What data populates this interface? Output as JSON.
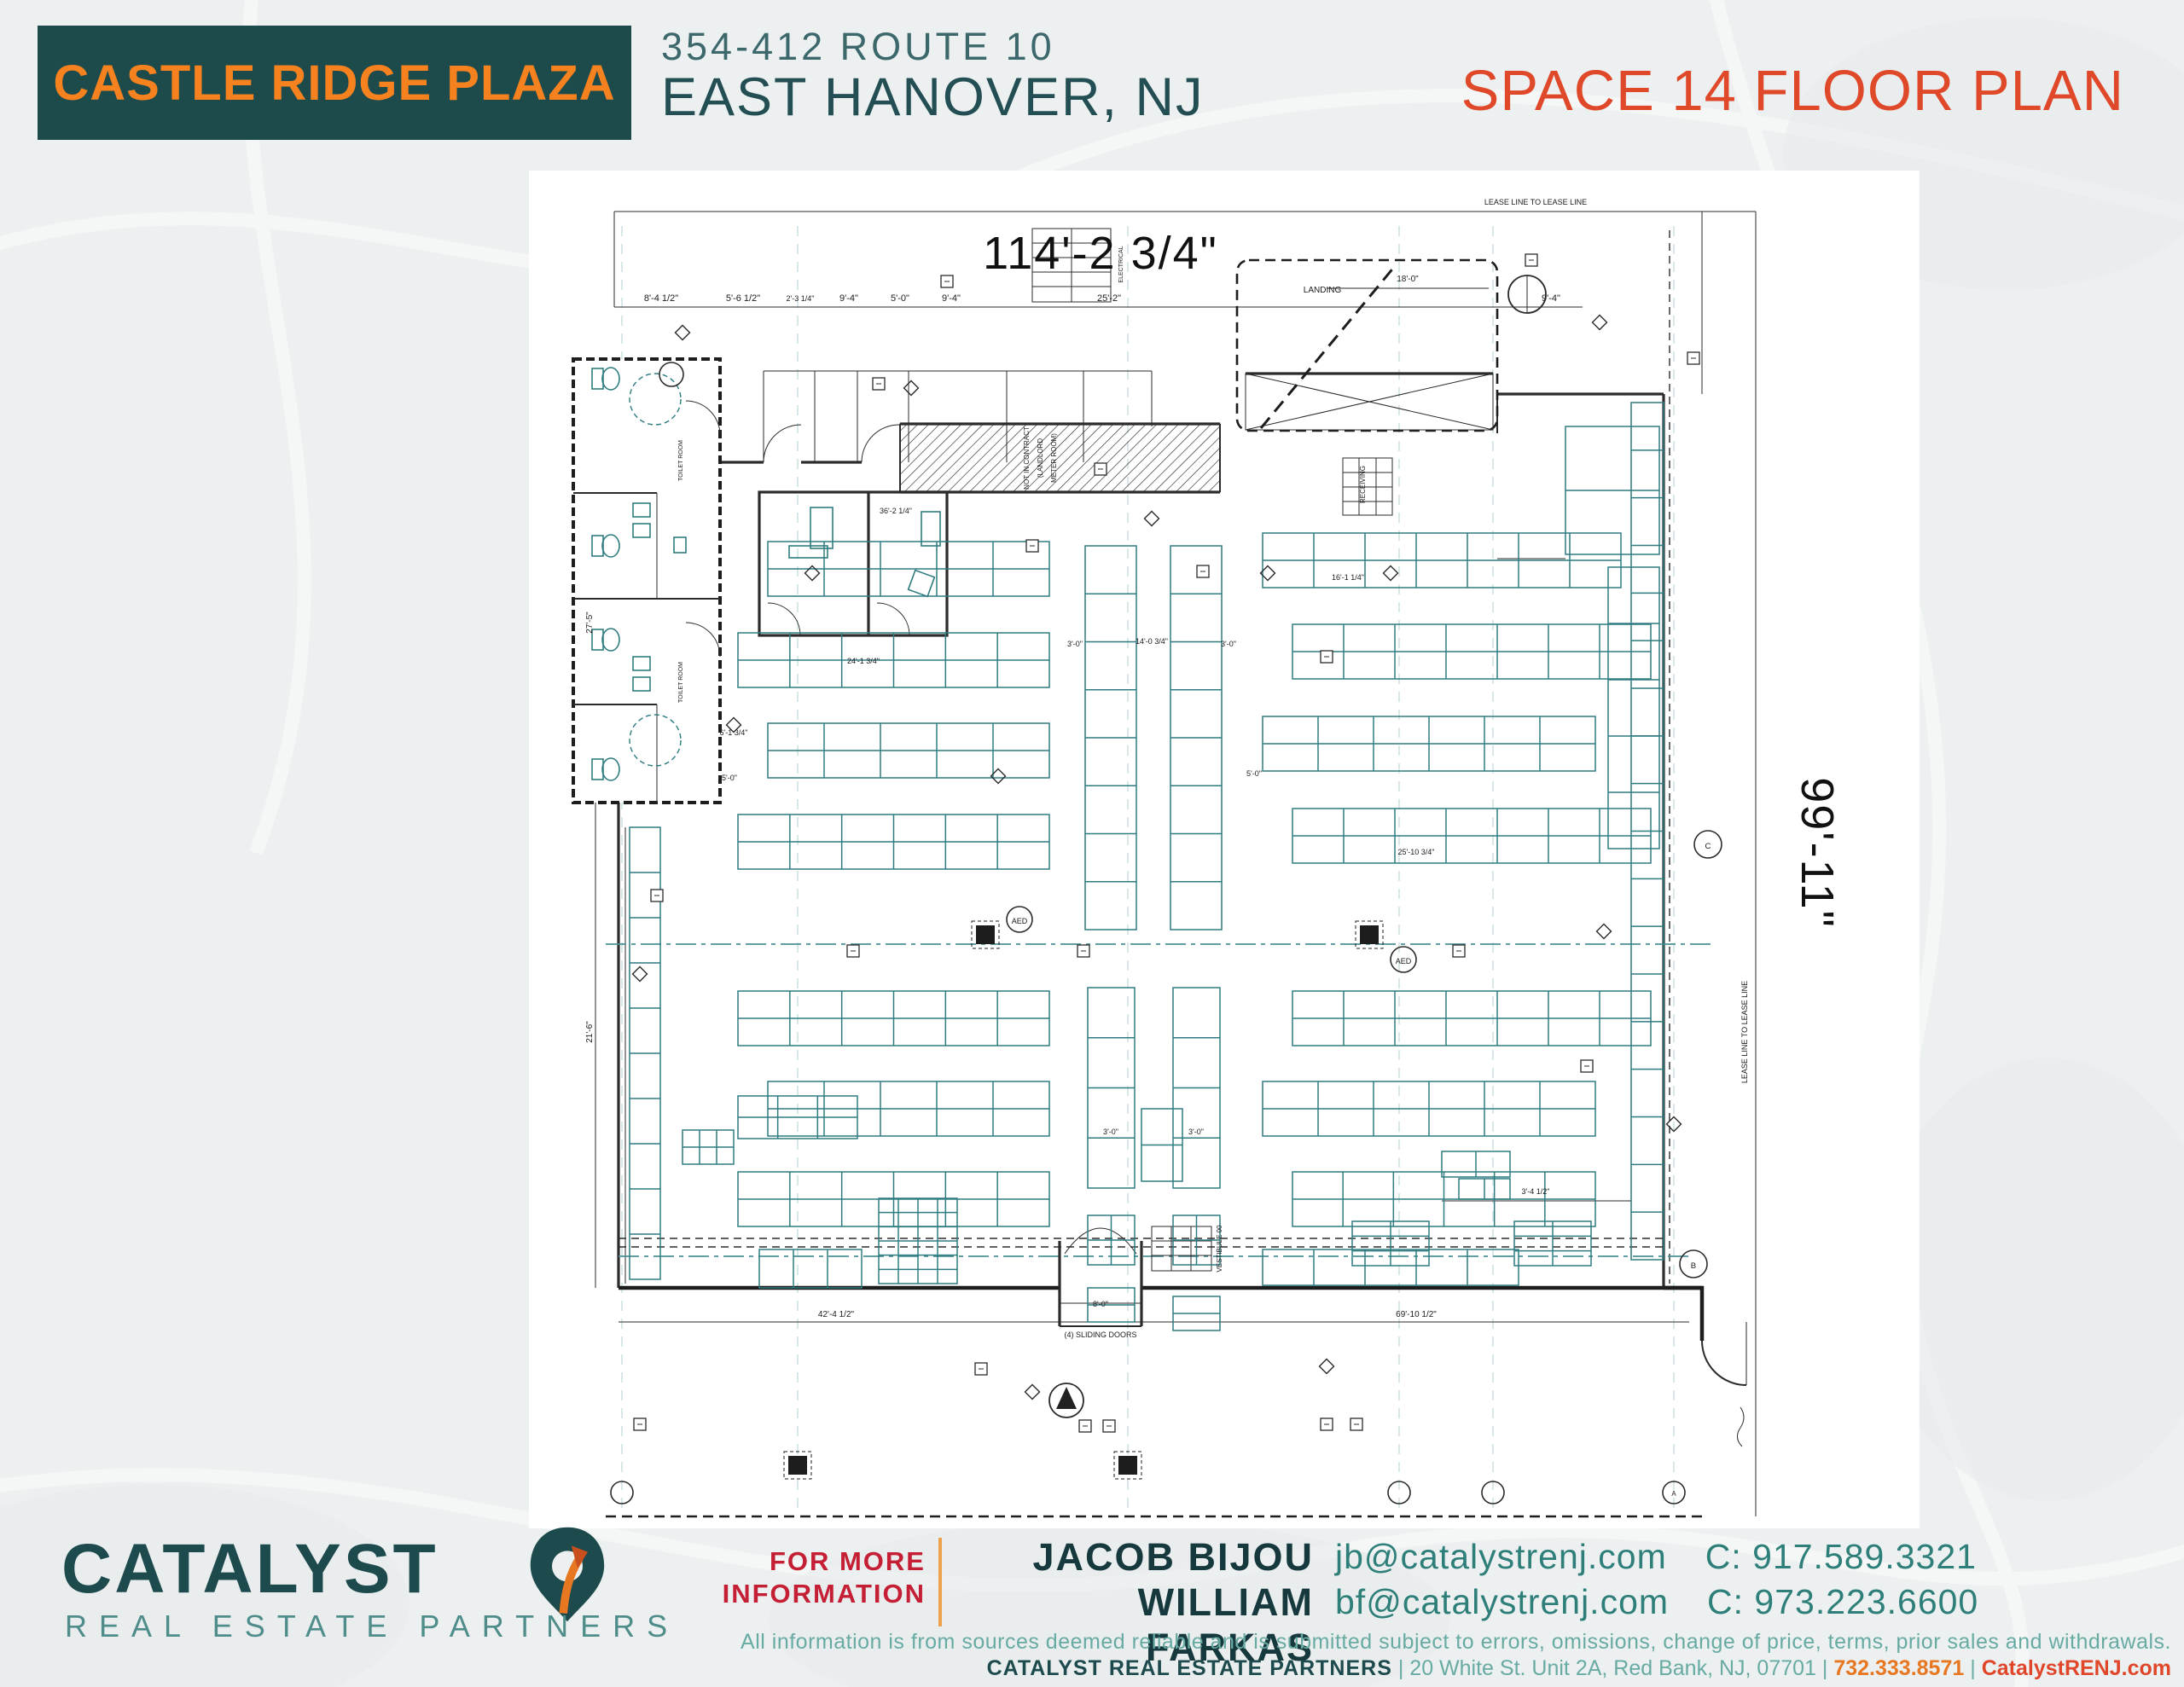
{
  "header": {
    "plaza_name": "CASTLE RIDGE PLAZA",
    "address_line1": "354-412 ROUTE 10",
    "address_line2": "EAST HANOVER, NJ",
    "plan_title": "SPACE 14 FLOOR PLAN"
  },
  "colors": {
    "brand_teal": "#1d4a4b",
    "brand_orange": "#f5821f",
    "title_red": "#e0482a",
    "drawing_teal": "#2e7c80",
    "footer_red": "#c51f35"
  },
  "plan": {
    "dim_width": "114'-2 3/4\"",
    "dim_depth": "99'-11\"",
    "labels": [
      [
        1150,
        30,
        9,
        0,
        "LEASE LINE TO LEASE LINE"
      ],
      [
        125,
        143,
        11,
        0,
        "8'-4 1/2\""
      ],
      [
        221,
        143,
        11,
        0,
        "5'-6 1/2\""
      ],
      [
        288,
        143,
        9,
        0,
        "2'-3 1/4\""
      ],
      [
        345,
        143,
        11,
        0,
        "9'-4\""
      ],
      [
        405,
        143,
        11,
        0,
        "5'-0\""
      ],
      [
        465,
        143,
        11,
        0,
        "9'-4\""
      ],
      [
        650,
        143,
        11,
        0,
        "25'-2\""
      ],
      [
        1168,
        143,
        11,
        0,
        "9'-4\""
      ],
      [
        900,
        133,
        10,
        0,
        "LANDING"
      ],
      [
        1000,
        120,
        10,
        0,
        "18'-0\""
      ],
      [
        556,
        327,
        8,
        -90,
        "NOT IN CONTRACT"
      ],
      [
        572,
        327,
        8,
        -90,
        "(LANDLORD"
      ],
      [
        588,
        327,
        8,
        -90,
        "METER ROOM)"
      ],
      [
        400,
        392,
        9,
        0,
        "36'-2 1/4\""
      ],
      [
        362,
        568,
        9,
        0,
        "24'-1 3/4\""
      ],
      [
        930,
        470,
        9,
        0,
        "16'-1 1/4\""
      ],
      [
        1010,
        792,
        9,
        0,
        "25'-10 3/4\""
      ],
      [
        950,
        358,
        8,
        -90,
        "RECEIVING"
      ],
      [
        666,
        100,
        7,
        -90,
        "ELECTRICAL"
      ],
      [
        150,
        330,
        7,
        -90,
        "TOILET ROOM"
      ],
      [
        150,
        590,
        7,
        -90,
        "TOILET ROOM"
      ],
      [
        44,
        520,
        10,
        -90,
        "27'-5\""
      ],
      [
        44,
        1000,
        10,
        -90,
        "21'-6\""
      ],
      [
        210,
        652,
        9,
        0,
        "6'-1 3/4\""
      ],
      [
        205,
        705,
        9,
        0,
        "5'-0\""
      ],
      [
        820,
        700,
        9,
        0,
        "5'-0\""
      ],
      [
        610,
        548,
        9,
        0,
        "3'-0\""
      ],
      [
        700,
        545,
        9,
        0,
        "14'-0 3/4\""
      ],
      [
        790,
        548,
        9,
        0,
        "3'-0\""
      ],
      [
        652,
        1120,
        9,
        0,
        "3'-0\""
      ],
      [
        752,
        1120,
        9,
        0,
        "3'-0\""
      ],
      [
        1150,
        1190,
        9,
        0,
        "3'-4 1/2\""
      ],
      [
        330,
        1334,
        10,
        0,
        "42'-4 1/2\""
      ],
      [
        1010,
        1334,
        10,
        0,
        "69'-10 1/2\""
      ],
      [
        640,
        1322,
        9,
        0,
        "8'-0\""
      ],
      [
        640,
        1358,
        9,
        0,
        "(4) SLIDING DOORS"
      ],
      [
        782,
        1254,
        8,
        -90,
        "VESTIBULE 00"
      ],
      [
        1398,
        1000,
        9,
        -90,
        "LEASE LINE TO LEASE LINE"
      ]
    ],
    "racks": [
      [
        250,
        425,
        330,
        64,
        5,
        2
      ],
      [
        215,
        532,
        365,
        64,
        6,
        2
      ],
      [
        250,
        638,
        330,
        64,
        5,
        2
      ],
      [
        215,
        745,
        365,
        64,
        6,
        2
      ],
      [
        215,
        952,
        365,
        64,
        6,
        2
      ],
      [
        250,
        1058,
        330,
        64,
        5,
        2
      ],
      [
        215,
        1164,
        365,
        64,
        6,
        2
      ],
      [
        830,
        415,
        420,
        64,
        7,
        2
      ],
      [
        865,
        522,
        420,
        64,
        7,
        2
      ],
      [
        830,
        630,
        390,
        64,
        6,
        2
      ],
      [
        865,
        738,
        420,
        64,
        7,
        2
      ],
      [
        865,
        952,
        420,
        64,
        7,
        2
      ],
      [
        830,
        1058,
        390,
        64,
        6,
        2
      ],
      [
        865,
        1164,
        355,
        64,
        6,
        2
      ],
      [
        830,
        1255,
        300,
        42,
        5,
        1
      ],
      [
        622,
        430,
        60,
        450,
        1,
        8
      ],
      [
        722,
        430,
        60,
        450,
        1,
        8
      ],
      [
        625,
        948,
        55,
        235,
        1,
        4
      ],
      [
        725,
        948,
        55,
        235,
        1,
        4
      ],
      [
        688,
        1090,
        48,
        85,
        1,
        2
      ],
      [
        625,
        1215,
        55,
        58,
        2,
        2
      ],
      [
        725,
        1215,
        55,
        58,
        2,
        2
      ],
      [
        625,
        1300,
        55,
        40,
        1,
        2
      ],
      [
        725,
        1310,
        55,
        40,
        1,
        2
      ],
      [
        88,
        760,
        36,
        530,
        1,
        10
      ],
      [
        1262,
        262,
        38,
        1005,
        1,
        18
      ],
      [
        1185,
        290,
        110,
        150,
        1,
        2
      ],
      [
        1235,
        455,
        60,
        330,
        1,
        5
      ],
      [
        935,
        1222,
        90,
        52,
        2,
        3
      ],
      [
        1125,
        1222,
        90,
        52,
        2,
        3
      ],
      [
        380,
        1195,
        92,
        100,
        4,
        6
      ],
      [
        215,
        1075,
        140,
        50,
        3,
        2
      ],
      [
        150,
        1115,
        60,
        40,
        3,
        2
      ],
      [
        1040,
        1140,
        80,
        30,
        2,
        1
      ],
      [
        1060,
        1172,
        60,
        24,
        2,
        1
      ],
      [
        240,
        1255,
        120,
        45,
        3,
        1
      ]
    ],
    "grid_xs": [
      79,
      285,
      672,
      990,
      1100,
      1312
    ],
    "bubbles": [
      [
        79,
        1540,
        13,
        ""
      ],
      [
        990,
        1540,
        13,
        ""
      ],
      [
        1100,
        1540,
        13,
        ""
      ],
      [
        1312,
        1540,
        13,
        "A"
      ],
      [
        1352,
        780,
        16,
        "C"
      ],
      [
        1335,
        1272,
        16,
        "B"
      ],
      [
        137,
        229,
        14,
        ""
      ],
      [
        545,
        868,
        15,
        "AED"
      ],
      [
        995,
        915,
        15,
        "AED"
      ]
    ],
    "columns": [
      [
        505,
        886
      ],
      [
        955,
        886
      ],
      [
        285,
        1508
      ],
      [
        672,
        1508
      ]
    ],
    "diamonds": [
      [
        150,
        180
      ],
      [
        418,
        245
      ],
      [
        700,
        398
      ],
      [
        836,
        462
      ],
      [
        980,
        462
      ],
      [
        210,
        640
      ],
      [
        1225,
        168
      ],
      [
        1312,
        1108
      ],
      [
        560,
        1422
      ],
      [
        905,
        1392
      ],
      [
        100,
        932
      ],
      [
        1230,
        882
      ],
      [
        302,
        462
      ],
      [
        520,
        700
      ]
    ],
    "tags": [
      [
        460,
        120
      ],
      [
        380,
        240
      ],
      [
        560,
        430
      ],
      [
        640,
        340
      ],
      [
        760,
        460
      ],
      [
        905,
        560
      ],
      [
        1145,
        95
      ],
      [
        1335,
        210
      ],
      [
        120,
        840
      ],
      [
        350,
        905
      ],
      [
        620,
        905
      ],
      [
        1060,
        905
      ],
      [
        500,
        1395
      ],
      [
        622,
        1462
      ],
      [
        650,
        1462
      ],
      [
        905,
        1460
      ],
      [
        940,
        1460
      ],
      [
        1210,
        1040
      ],
      [
        100,
        1460
      ]
    ]
  },
  "footer": {
    "logo_name": "CATALYST",
    "logo_sub": "REAL ESTATE PARTNERS",
    "for_more_line1": "FOR MORE",
    "for_more_line2": "INFORMATION",
    "agent1": "JACOB BIJOU",
    "agent2": "WILLIAM FARKAS",
    "email1": "jb@catalystrenj.com",
    "phone1": "C: 917.589.3321",
    "email2": "bf@catalystrenj.com",
    "phone2": "C: 973.223.6600",
    "disclaimer": "All information is from sources deemed reliable and is submitted subject to errors, omissions, change of price, terms, prior sales and withdrawals.",
    "company": "CATALYST REAL ESTATE PARTNERS",
    "address": "20 White St. Unit 2A, Red Bank, NJ, 07701",
    "phone": "732.333.8571",
    "website": "CatalystRENJ.com",
    "sep": "|"
  }
}
